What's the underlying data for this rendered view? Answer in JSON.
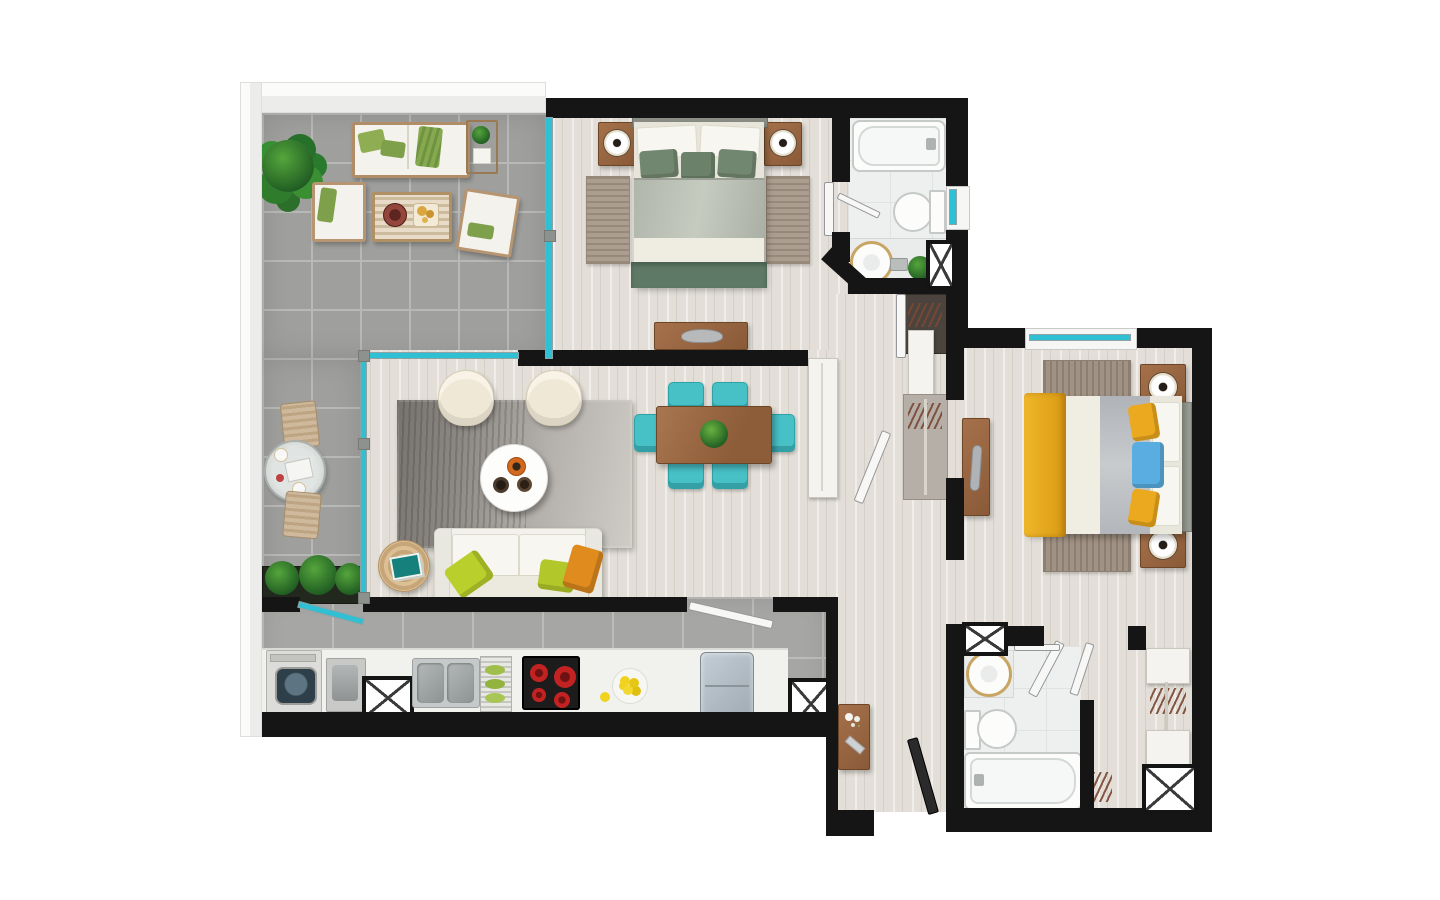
{
  "meta": {
    "title": "Apartment floor plan – top-down 3D render",
    "style": "photorealistic furnished plan on white background",
    "visible_text": "none"
  },
  "palette": {
    "wall": "#151515",
    "parapet": "#ececea",
    "terrace_tile": "#9f9f9d",
    "terrace_grout": "#b8b8b6",
    "kitchen_tile": "#a6a6a4",
    "wood": "#e3dfd8",
    "bath_floor": "#edf0ef",
    "glass": "#2fc0d4",
    "teal_chair": "#47c1c6",
    "rug_tan": "#ab9d8f",
    "sofa_white": "#f2f1eb",
    "pillow_green": "#b9cf2c",
    "pillow_orange": "#df8b1e",
    "bed1_green": "#72876f",
    "bed1_runner": "#5e7a66",
    "bed2_yellow": "#eaa91e",
    "pillow_blue": "#5aade0",
    "wood_furniture": "#96613d",
    "stove_black": "#1c1c1c",
    "burner_red": "#c32222",
    "lemon_yellow": "#f0d21f",
    "plant_green": "#2f7d2f"
  },
  "rooms": {
    "terrace": {
      "label": "Terrace / balcony",
      "furniture": [
        "potted plant",
        "outdoor sofa with green pillows",
        "slatted side table with plant",
        "lounge chair",
        "slatted coffee table with tray and snacks",
        "second lounge chair",
        "round glass bistro table with two chairs and breakfast set",
        "planter box with plants"
      ]
    },
    "master_bedroom": {
      "label": "Master bedroom",
      "furniture": [
        "double bed with sage green bedding",
        "two nightstands with round lamps",
        "two bedside runner rugs",
        "low media dresser with laptop"
      ]
    },
    "bathroom_1": {
      "label": "Main bathroom",
      "furniture": [
        "bathtub with faucet",
        "toilet",
        "round countertop basin",
        "faucet",
        "small plant",
        "duct shaft",
        "window",
        "towel bar",
        "door"
      ]
    },
    "hallway": {
      "label": "Hallway / closets",
      "furniture": [
        "dark closet with hangers",
        "tall white wardrobe",
        "closet panel with hanging rods",
        "open door leaf"
      ]
    },
    "living_room": {
      "label": "Living room",
      "furniture": [
        "large grey area rug",
        "two cream lounge armchairs",
        "round white coffee table with three bowls",
        "three-seat white sofa with chartreuse and orange pillows",
        "round jute side table with teal book"
      ]
    },
    "dining_area": {
      "label": "Dining area",
      "furniture": [
        "wooden dining table with plant centerpiece",
        "six teal chairs",
        "tall white cabinet"
      ]
    },
    "kitchen": {
      "label": "Kitchen",
      "furniture": [
        "washing machine",
        "laundry basin",
        "duct shaft",
        "double stainless sink",
        "dish rack with green plates",
        "four-burner cooktop",
        "plate of lemons",
        "refrigerator",
        "duct shaft",
        "sliding glass door to terrace",
        "open door to hall"
      ]
    },
    "entry_hall": {
      "label": "Entry hall",
      "furniture": [
        "wooden console with white flowers",
        "entrance door (open leaf)"
      ]
    },
    "bedroom_2": {
      "label": "Bedroom 2",
      "furniture": [
        "double bed with yellow throw, grey duvet, yellow and blue pillows",
        "two nightstands with round lamps",
        "two striped rugs",
        "wall desk with grey object",
        "window"
      ]
    },
    "bathroom_2": {
      "label": "Second bathroom",
      "furniture": [
        "round countertop basin",
        "toilet",
        "bathtub",
        "towel bar",
        "duct shaft",
        "door"
      ]
    },
    "walk_in_closet": {
      "label": "Walk-in closet",
      "furniture": [
        "two white shelf units",
        "hanging rod with hangers",
        "duct shaft"
      ]
    }
  },
  "openings": {
    "sliding_glass_doors": 3,
    "windows": 2,
    "interior_doors": 6,
    "entrance_gap": "bottom of entry hall",
    "duct_shafts": 5
  }
}
